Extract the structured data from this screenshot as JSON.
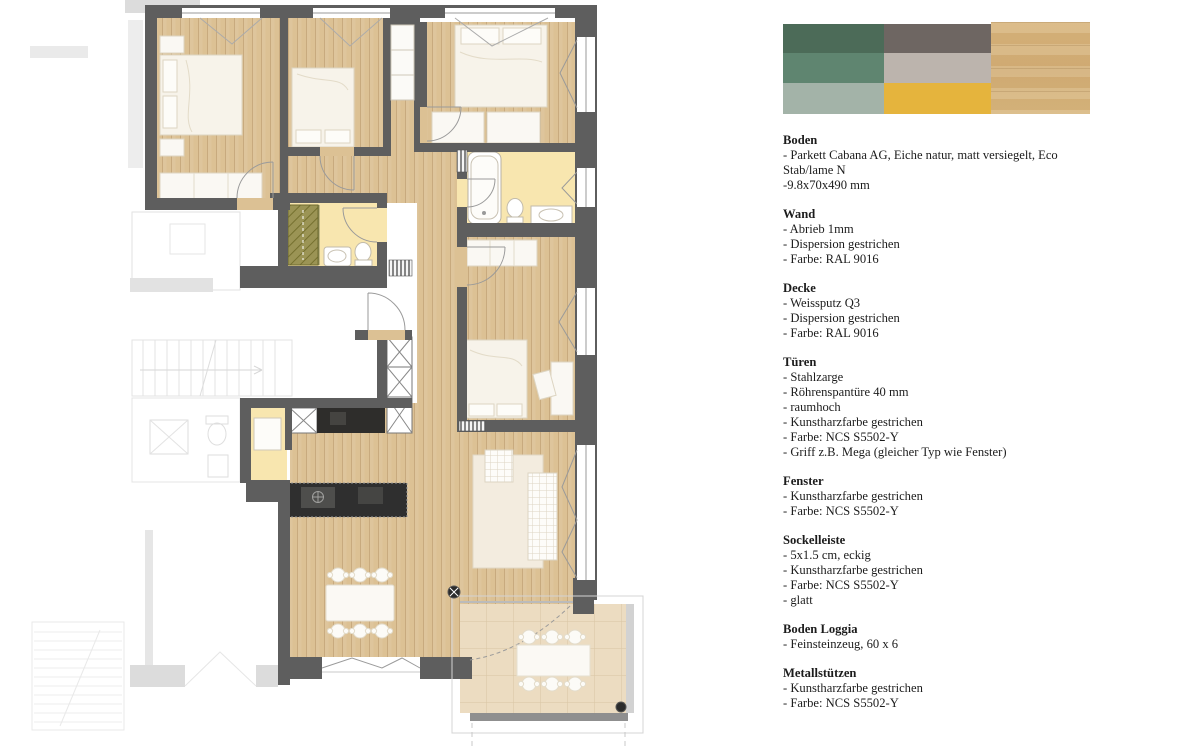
{
  "panel": {
    "palette": {
      "swatches": [
        {
          "name": "dark-green",
          "hex": "#4C6B58"
        },
        {
          "name": "dark-taupe",
          "hex": "#6E6662"
        },
        {
          "name": "medium-green",
          "hex": "#5F8570"
        },
        {
          "name": "light-greige",
          "hex": "#BCB4AD"
        },
        {
          "name": "sage-green",
          "hex": "#A3B3A8"
        },
        {
          "name": "mustard-yellow",
          "hex": "#E5B43D"
        }
      ],
      "wood_swatch": {
        "name": "oak-parquet",
        "hex": "#D7B57F"
      }
    },
    "sections": [
      {
        "title": "Boden",
        "items": [
          "- Parkett Cabana AG, Eiche natur, matt versiegelt, Eco Stab/lame N",
          "-9.8x70x490 mm"
        ]
      },
      {
        "title": "Wand",
        "items": [
          "- Abrieb 1mm",
          "- Dispersion gestrichen",
          "- Farbe: RAL 9016"
        ]
      },
      {
        "title": "Decke",
        "items": [
          "- Weissputz Q3",
          "- Dispersion gestrichen",
          "- Farbe: RAL 9016"
        ]
      },
      {
        "title": "Türen",
        "items": [
          "- Stahlzarge",
          "- Röhrenspantüre 40 mm",
          "- raumhoch",
          "- Kunstharzfarbe gestrichen",
          "- Farbe: NCS S5502-Y",
          "- Griff z.B. Mega (gleicher Typ wie Fenster)"
        ]
      },
      {
        "title": "Fenster",
        "items": [
          "- Kunstharzfarbe gestrichen",
          "- Farbe: NCS S5502-Y"
        ]
      },
      {
        "title": "Sockelleiste",
        "items": [
          "- 5x1.5 cm, eckig",
          "- Kunstharzfarbe gestrichen",
          "- Farbe: NCS S5502-Y",
          "- glatt"
        ]
      },
      {
        "title": "Boden Loggia",
        "items": [
          "- Feinsteinzeug, 60 x 6"
        ]
      },
      {
        "title": "Metallstützen",
        "items": [
          "- Kunstharzfarbe gestrichen",
          "- Farbe: NCS S5502-Y"
        ]
      }
    ]
  },
  "floor_plan": {
    "colors": {
      "wall": "#5E5E5E",
      "wood_floor": "#DCC194",
      "bathroom_floor": "#F8E6AF",
      "shower": "#9B9455",
      "kitchen_counter": "#2E2D2B",
      "loggia_tile": "#ECDCC1"
    }
  }
}
